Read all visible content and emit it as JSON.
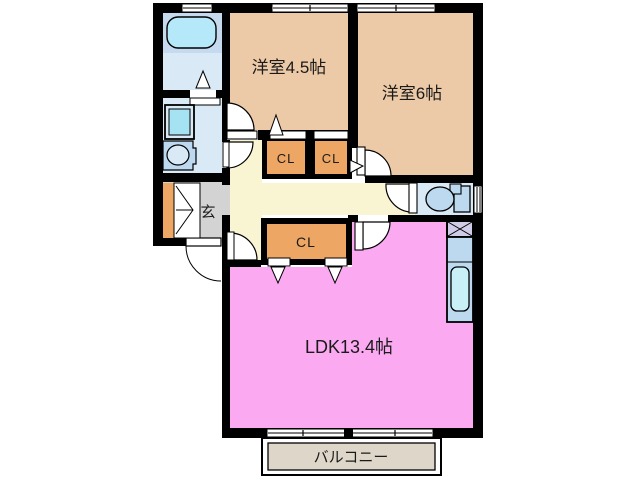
{
  "plan": {
    "type": "floorplan",
    "labels": {
      "room45": "洋室4.5帖",
      "room6": "洋室6帖",
      "ldk": "LDK13.4帖",
      "cl": "CL",
      "genkan": "玄",
      "balcony": "バルコニー"
    },
    "rooms": [
      {
        "name": "western-room-4.5",
        "label": "洋室4.5帖",
        "size_jo": 4.5
      },
      {
        "name": "western-room-6",
        "label": "洋室6帖",
        "size_jo": 6
      },
      {
        "name": "living-dining-kitchen",
        "label": "LDK13.4帖",
        "size_jo": 13.4
      },
      {
        "name": "closet",
        "label": "CL",
        "count": 3
      },
      {
        "name": "entrance",
        "label": "玄"
      },
      {
        "name": "balcony",
        "label": "バルコニー"
      },
      {
        "name": "bathroom"
      },
      {
        "name": "washroom"
      },
      {
        "name": "toilet"
      },
      {
        "name": "hallway"
      }
    ],
    "colors": {
      "wall": "#000000",
      "room_tan": "#edcaa7",
      "ldk_pink": "#fbaaf2",
      "hallway_cream": "#f9f5d3",
      "closet_orange": "#eda663",
      "genkan_gray": "#d3d3d3",
      "water_blue": "#d9e9f5",
      "bath_platform": "#c5daef",
      "tub_blue": "#b5e9f9",
      "fixture_blue": "#bdd9f0",
      "sink_blue": "#c9f0f7",
      "machine_blue": "#a5e2f2",
      "pipe_lavender": "#cfcbe8",
      "balcony_beige": "#ded7c9",
      "background": "#ffffff"
    }
  }
}
